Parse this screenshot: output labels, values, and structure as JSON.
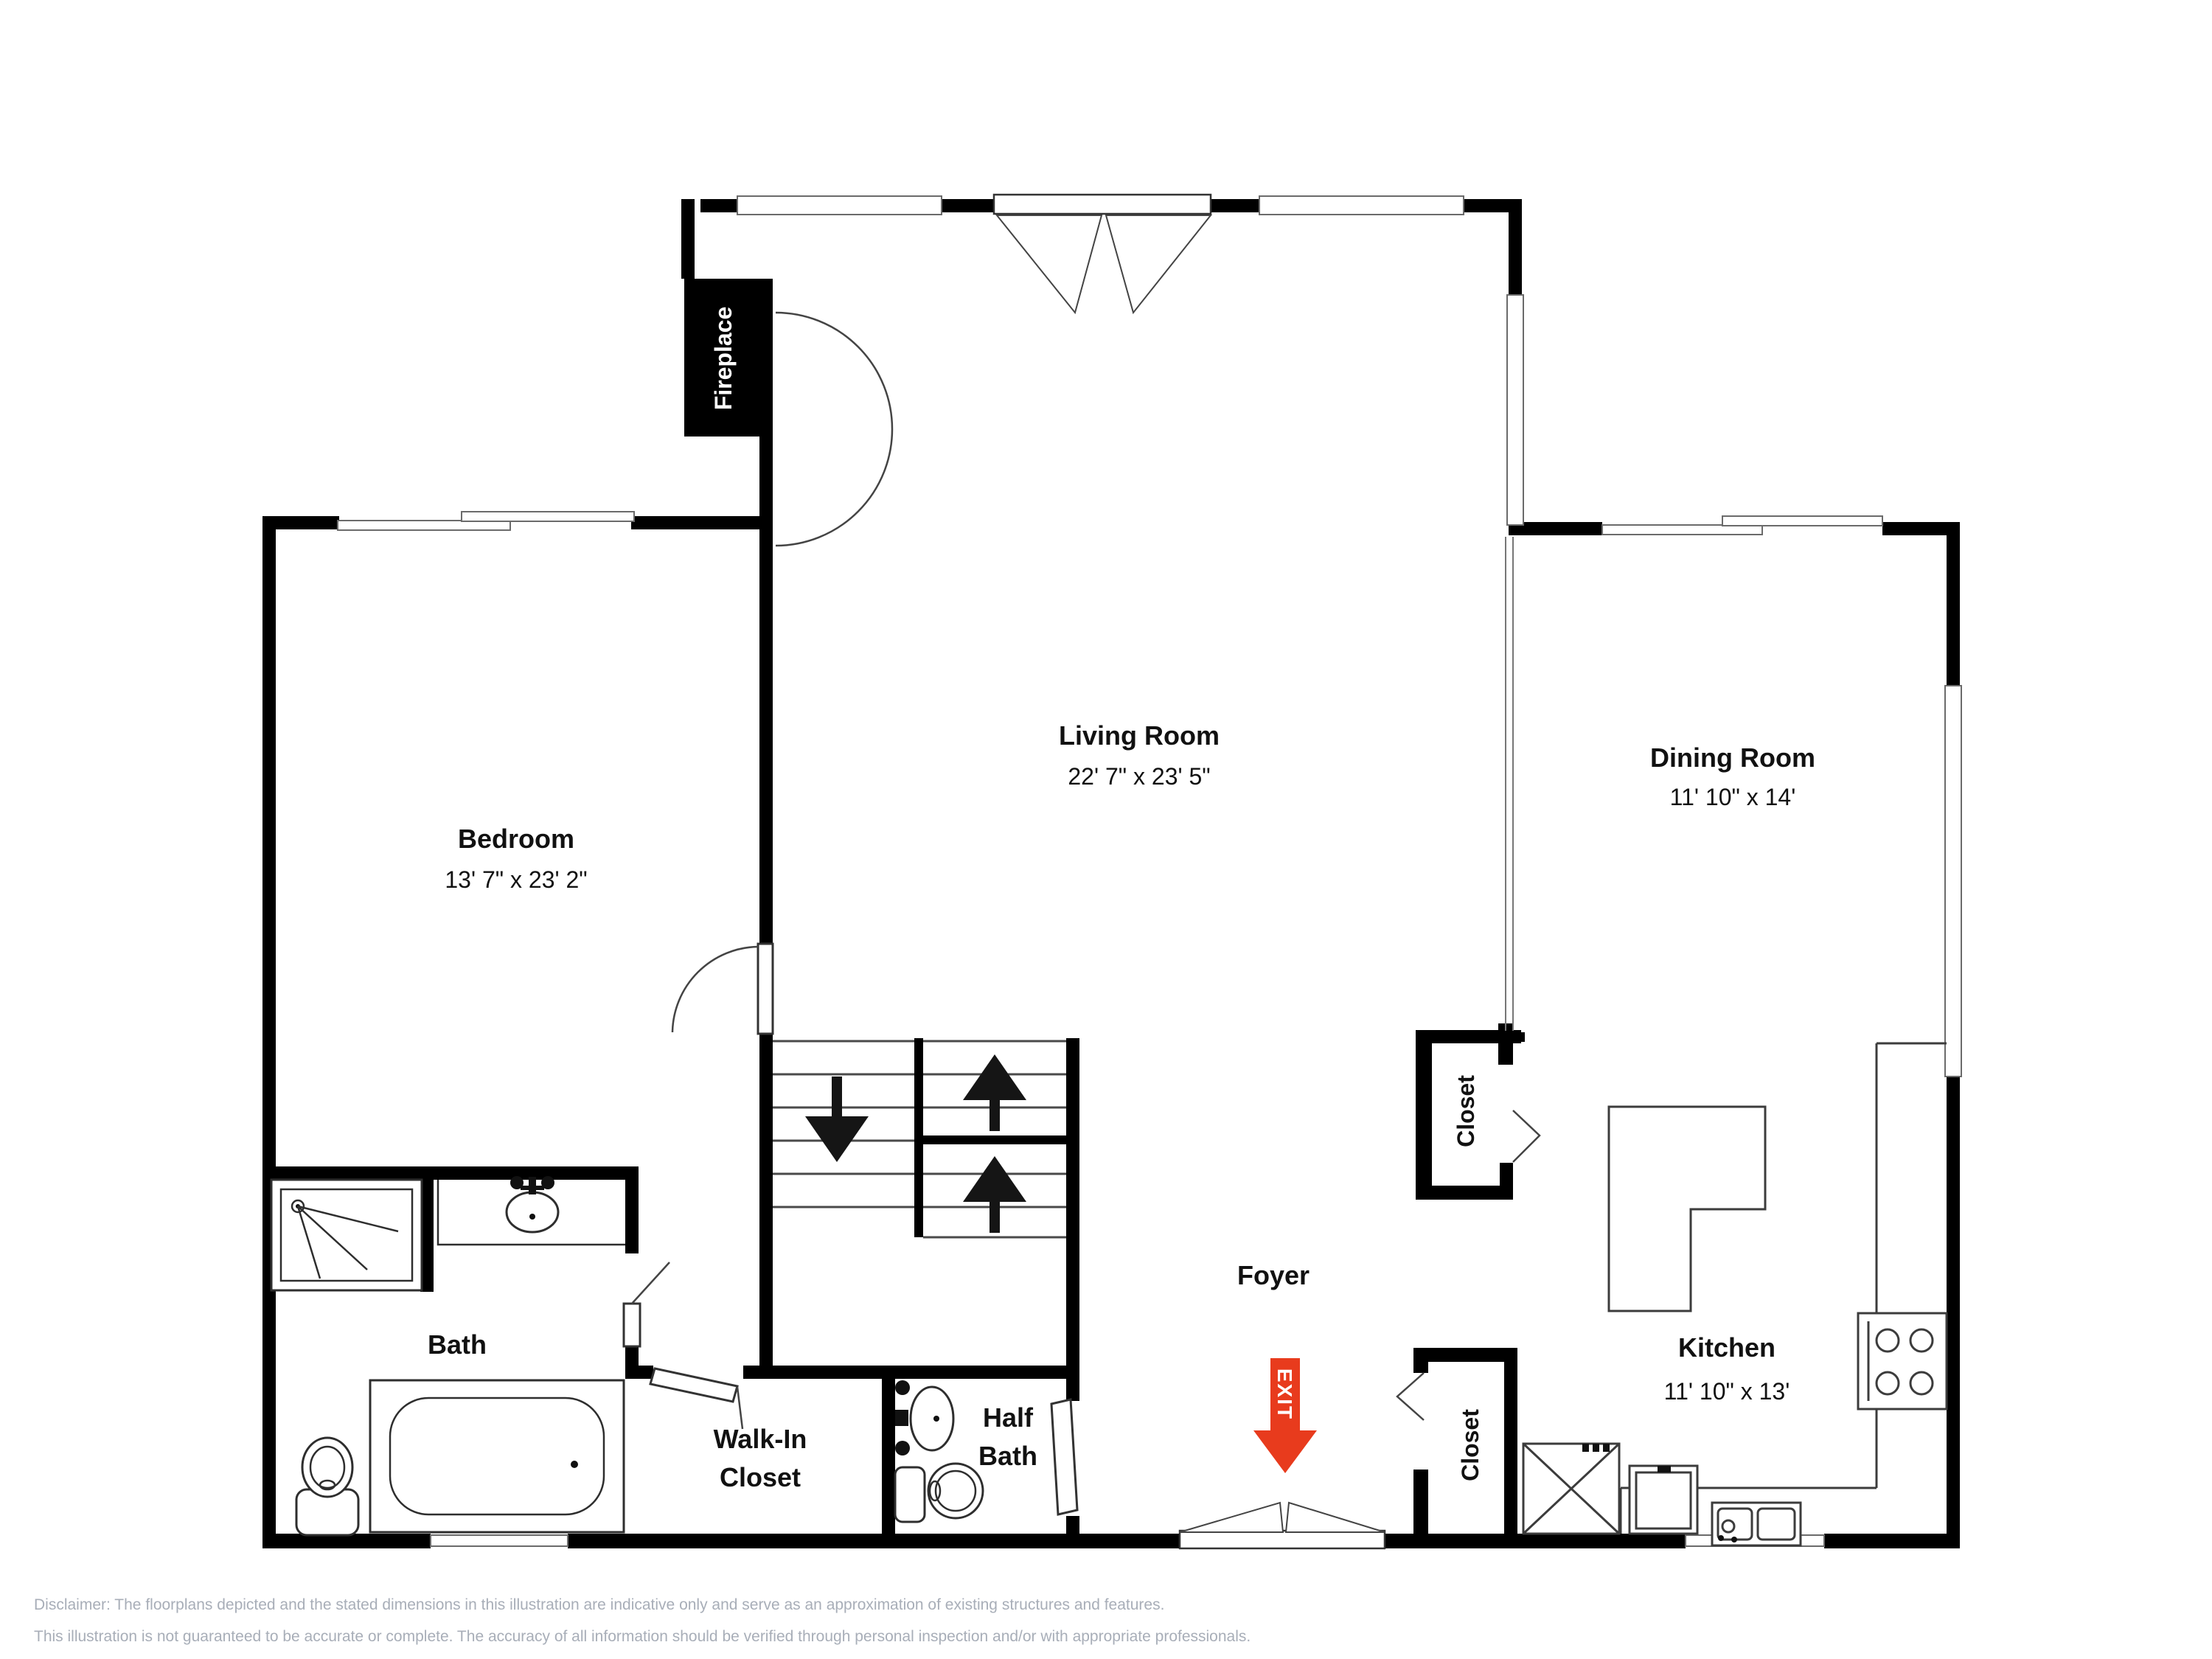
{
  "plan": {
    "labels": {
      "living_name": "Living Room",
      "living_dims": "22' 7\" x 23' 5\"",
      "bedroom_name": "Bedroom",
      "bedroom_dims": "13' 7\" x 23' 2\"",
      "dining_name": "Dining Room",
      "dining_dims": "11' 10\" x 14'",
      "kitchen_name": "Kitchen",
      "kitchen_dims": "11' 10\" x 13'",
      "bath": "Bath",
      "half_bath_line1": "Half",
      "half_bath_line2": "Bath",
      "walk_in_line1": "Walk-In",
      "walk_in_line2": "Closet",
      "foyer": "Foyer",
      "closet_upper": "Closet",
      "closet_lower": "Closet",
      "fireplace": "Fireplace",
      "exit": "EXIT"
    },
    "colors": {
      "wall": "#000000",
      "exit_red": "#e83b1d",
      "disclaimer_text": "#a8aeb8"
    },
    "disclaimer_line1": "Disclaimer: The floorplans depicted and the stated dimensions in this illustration are indicative only and serve as an approximation of existing structures and features.",
    "disclaimer_line2": "This illustration is not guaranteed to be accurate or complete. The accuracy of all information should be verified through personal inspection and/or with appropriate professionals."
  }
}
